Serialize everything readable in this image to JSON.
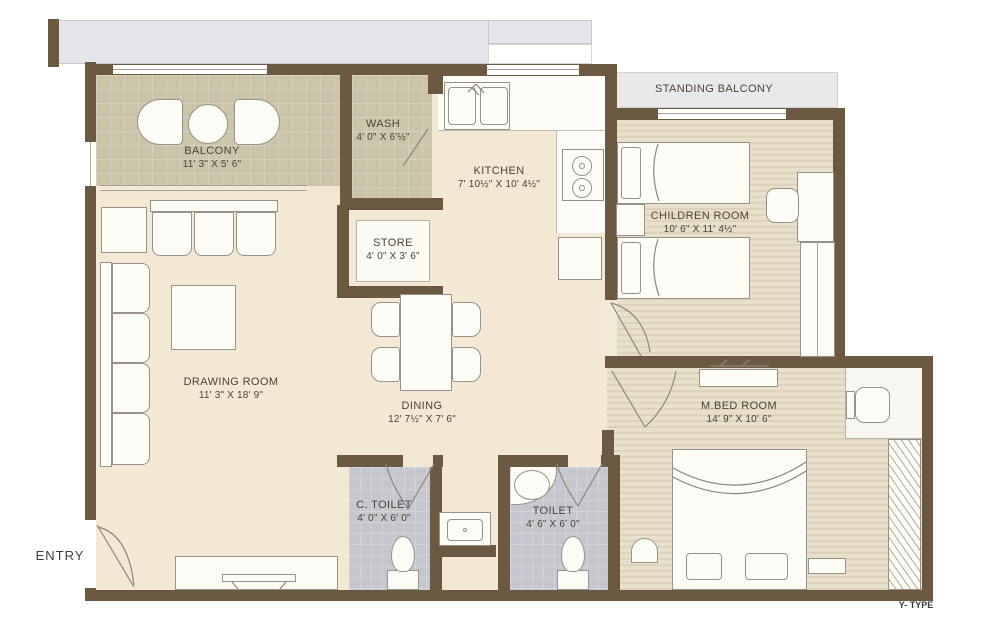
{
  "plan": {
    "rooms": {
      "balcony": {
        "name": "BALCONY",
        "dims": "11' 3\" X 5' 6\""
      },
      "wash": {
        "name": "WASH",
        "dims": "4' 0\" X 6'½\""
      },
      "kitchen": {
        "name": "KITCHEN",
        "dims": "7' 10½\" X 10' 4½\""
      },
      "store": {
        "name": "STORE",
        "dims": "4' 0\" X 3' 6\""
      },
      "standing_balcony": {
        "name": "STANDING BALCONY"
      },
      "children_room": {
        "name": "CHILDREN ROOM",
        "dims": "10' 6\" X 11' 4½\""
      },
      "drawing_room": {
        "name": "DRAWING ROOM",
        "dims": "11' 3\" X 18' 9\""
      },
      "dining": {
        "name": "DINING",
        "dims": "12' 7½\" X 7' 6\""
      },
      "c_toilet": {
        "name": "C. TOILET",
        "dims": "4' 0\" X 6' 0\""
      },
      "toilet": {
        "name": "TOILET",
        "dims": "4' 6\" X 6' 0\""
      },
      "m_bed_room": {
        "name": "M.BED ROOM",
        "dims": "14' 9\" X 10' 6\""
      }
    },
    "annotations": {
      "entry": "ENTRY",
      "plan_type": "Y- TYPE"
    },
    "colors": {
      "wall": "#6b5942",
      "floor_cream": "#f2e8d3",
      "balcony_tile": "#cbc4a9",
      "toilet_tile": "#c6c6ce",
      "bedroom_floor": "#e8e0ca",
      "outdoor_gray": "#e6e6ea"
    }
  }
}
